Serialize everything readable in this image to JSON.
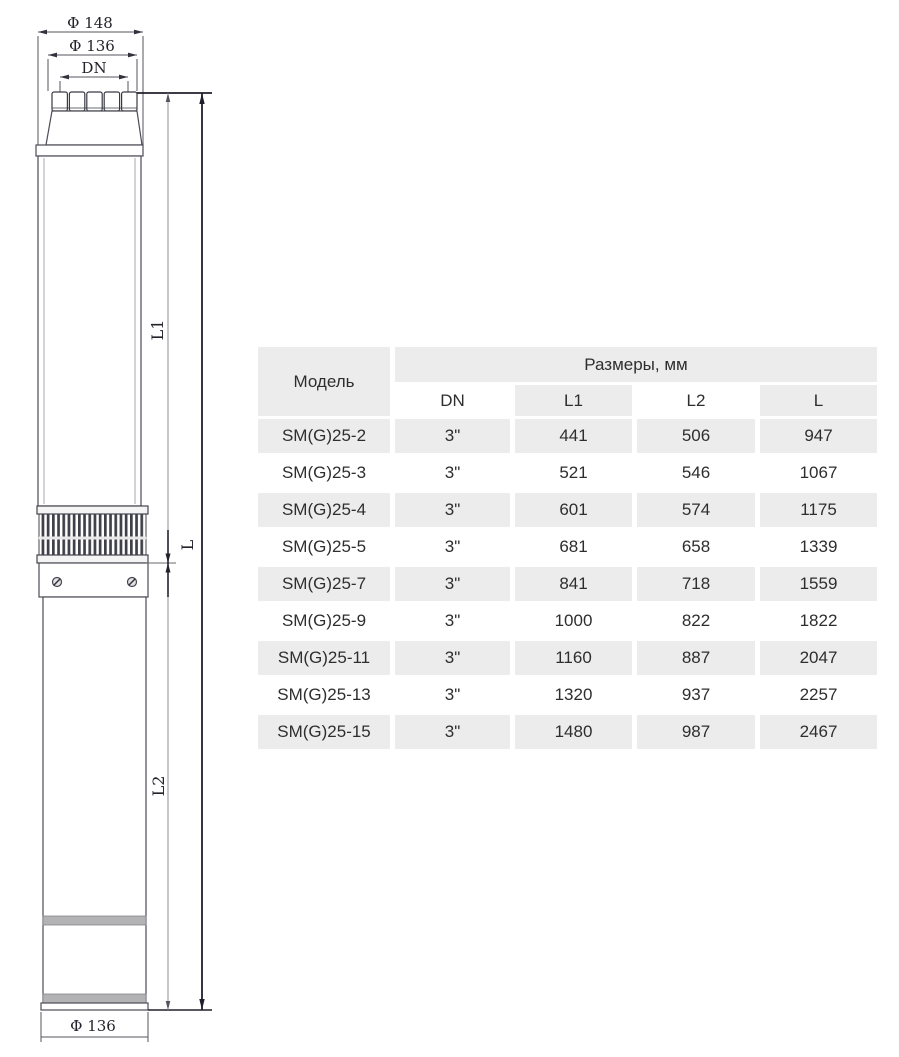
{
  "diagram": {
    "dim_outer_diameter": "Φ 148",
    "dim_cap_diameter": "Φ 136",
    "dim_port": "DN",
    "dim_pump_length": "L1",
    "dim_total_length": "L",
    "dim_motor_length": "L2",
    "dim_bottom_diameter": "Φ 136"
  },
  "table": {
    "model_header": "Модель",
    "size_header": "Размеры, мм",
    "columns": [
      "DN",
      "L1",
      "L2",
      "L"
    ],
    "rows": [
      {
        "model": "SM(G)25-2",
        "dn": "3\"",
        "l1": "441",
        "l2": "506",
        "l": "947"
      },
      {
        "model": "SM(G)25-3",
        "dn": "3\"",
        "l1": "521",
        "l2": "546",
        "l": "1067"
      },
      {
        "model": "SM(G)25-4",
        "dn": "3\"",
        "l1": "601",
        "l2": "574",
        "l": "1175"
      },
      {
        "model": "SM(G)25-5",
        "dn": "3\"",
        "l1": "681",
        "l2": "658",
        "l": "1339"
      },
      {
        "model": "SM(G)25-7",
        "dn": "3\"",
        "l1": "841",
        "l2": "718",
        "l": "1559"
      },
      {
        "model": "SM(G)25-9",
        "dn": "3\"",
        "l1": "1000",
        "l2": "822",
        "l": "1822"
      },
      {
        "model": "SM(G)25-11",
        "dn": "3\"",
        "l1": "1160",
        "l2": "887",
        "l": "2047"
      },
      {
        "model": "SM(G)25-13",
        "dn": "3\"",
        "l1": "1320",
        "l2": "937",
        "l": "2257"
      },
      {
        "model": "SM(G)25-15",
        "dn": "3\"",
        "l1": "1480",
        "l2": "987",
        "l": "2467"
      }
    ]
  },
  "colors": {
    "row_shade": "#ececec",
    "text": "#2e2e2e",
    "line_dark": "#20202c",
    "line_light": "#8d8d95",
    "band_gray": "#b3b3b3"
  }
}
